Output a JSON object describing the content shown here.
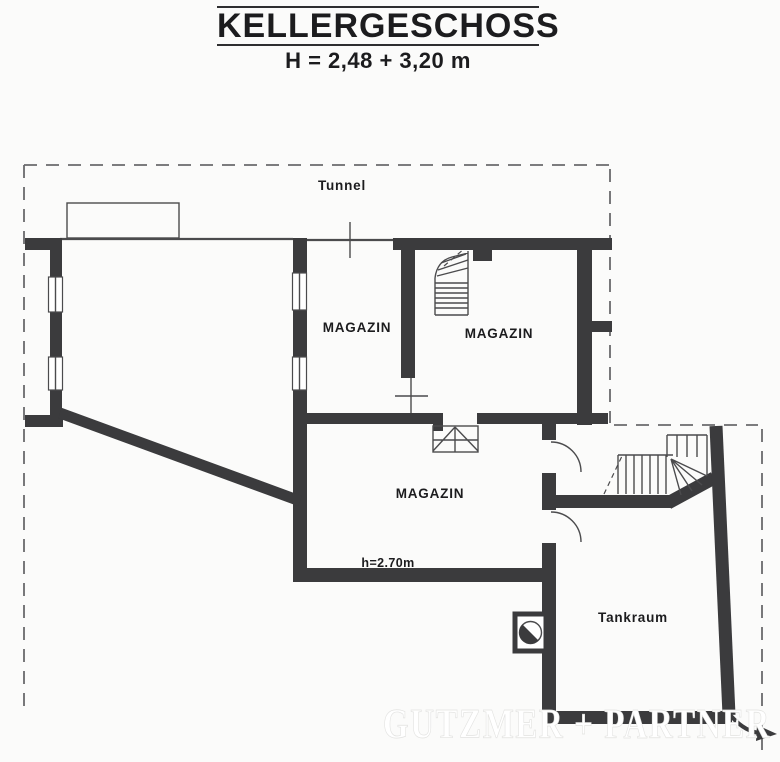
{
  "title": {
    "heading": "KELLERGESCHOSS",
    "subtitle": "H = 2,48 + 3,20 m"
  },
  "plan": {
    "labels": {
      "tunnel": "Tunnel",
      "magazin_left": "MAGAZIN",
      "magazin_upper": "MAGAZIN",
      "magazin_lower": "MAGAZIN",
      "height_note": "h=2.70m",
      "tankraum": "Tankraum"
    },
    "watermark": "GUTZMER + PARTNER",
    "colors": {
      "wall": "#3b3b3d",
      "line": "#4b4b4d",
      "dash": "#6a6a6c",
      "background": "#fbfbfa",
      "text": "#1c1c1e",
      "watermark": "#ffffff"
    }
  }
}
